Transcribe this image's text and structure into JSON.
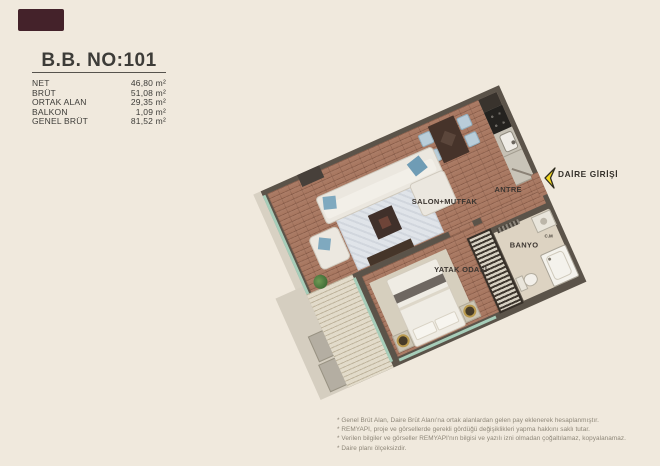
{
  "page": {
    "background": "#f0e9dd"
  },
  "brand": {
    "logo_color": "#44222a"
  },
  "unit": {
    "title": "B.B. NO:101",
    "areas": [
      {
        "label": "NET",
        "value": "46,80 m²"
      },
      {
        "label": "BRÜT",
        "value": "51,08 m²"
      },
      {
        "label": "ORTAK ALAN",
        "value": "29,35 m²"
      },
      {
        "label": "BALKON",
        "value": "1,09 m²"
      },
      {
        "label": "GENEL BRÜT",
        "value": "81,52 m²"
      }
    ]
  },
  "plan": {
    "rooms": [
      {
        "label": "SALON+MUTFAK"
      },
      {
        "label": "ANTRE"
      },
      {
        "label": "BANYO"
      },
      {
        "label": "YATAK ODASI"
      }
    ],
    "appliance_label": "C.M",
    "entrance": {
      "label": "DAİRE GİRİŞİ",
      "arrow_color": "#f2d71e"
    }
  },
  "footnotes": [
    "* Genel Brüt Alan, Daire Brüt Alanı'na ortak alanlardan gelen pay eklenerek hesaplanmıştır.",
    "* REMYAPI, proje ve görsellerde gerekli gördüğü değişiklikleri yapma hakkını saklı tutar.",
    "* Verilen bilgiler ve görseller REMYAPI'nın bilgisi ve yazılı izni olmadan çoğaltılamaz, kopyalanamaz.",
    "* Daire planı ölçeksizdir."
  ]
}
